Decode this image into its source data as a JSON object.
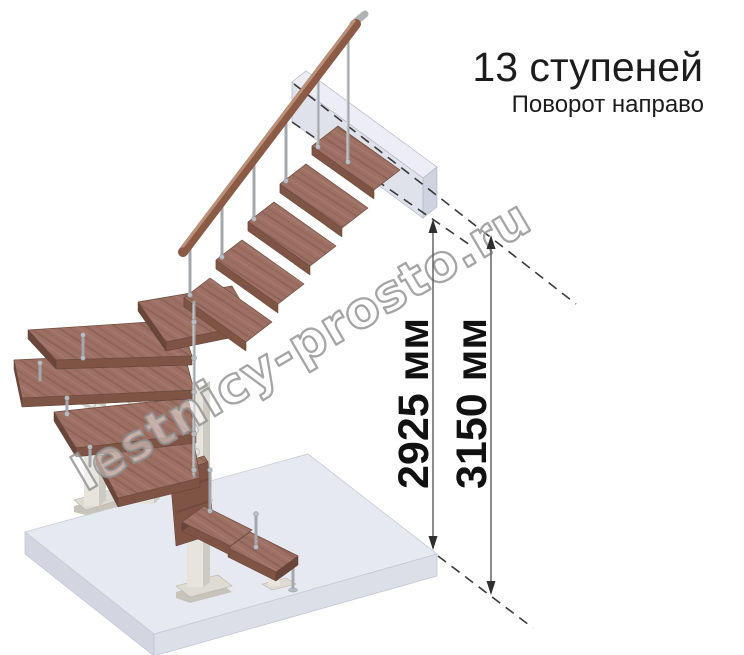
{
  "header": {
    "title": "13 ступеней",
    "subtitle": "Поворот направо"
  },
  "dimensions": {
    "inner_label": "2925 мм",
    "outer_label": "3150 мм"
  },
  "watermark": {
    "text": "lestnicy-prosto.ru"
  },
  "illustration": {
    "description": "3D render of modular L-shaped staircase turning right, 13 steps, wooden treads with metal balusters and wooden handrail, white modular spine supports, light grey floor slab and upper landing platform",
    "colors": {
      "wood_tread": "#9d7063",
      "wood_edge": "#7e5445",
      "handrail": "#8a5a48",
      "metal": "#a4a7ab",
      "support_white": "#e7e4dd",
      "platform": "#e7e9f1",
      "platform_side": "#d3d6e1",
      "dimension_text": "#111111",
      "watermark_outline": "#8e8e8e",
      "background": "#ffffff"
    }
  }
}
